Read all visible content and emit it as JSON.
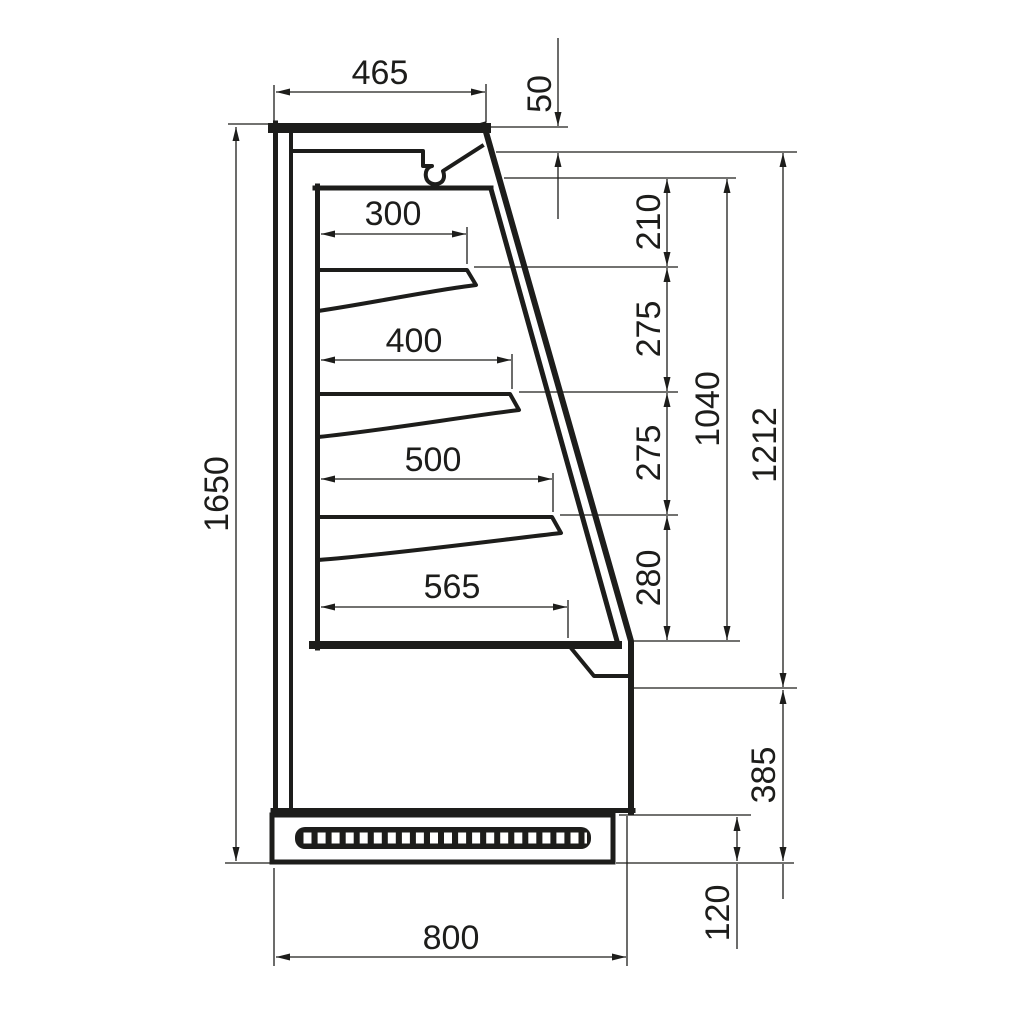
{
  "drawing": {
    "dimensions": {
      "top_depth": "465",
      "canopy_front_height": "50",
      "shelf_1_depth": "300",
      "shelf_2_depth": "400",
      "shelf_3_depth": "500",
      "base_shelf_depth": "565",
      "shelf_1_spacing": "210",
      "shelf_2_spacing": "275",
      "shelf_3_spacing": "275",
      "base_spacing": "280",
      "display_opening_height": "1040",
      "front_opening_height": "1212",
      "overall_height": "1650",
      "lower_front_height": "385",
      "plinth_height": "120",
      "overall_depth": "800"
    },
    "style": {
      "line_color": "#1d1d1b",
      "background": "#ffffff"
    }
  }
}
